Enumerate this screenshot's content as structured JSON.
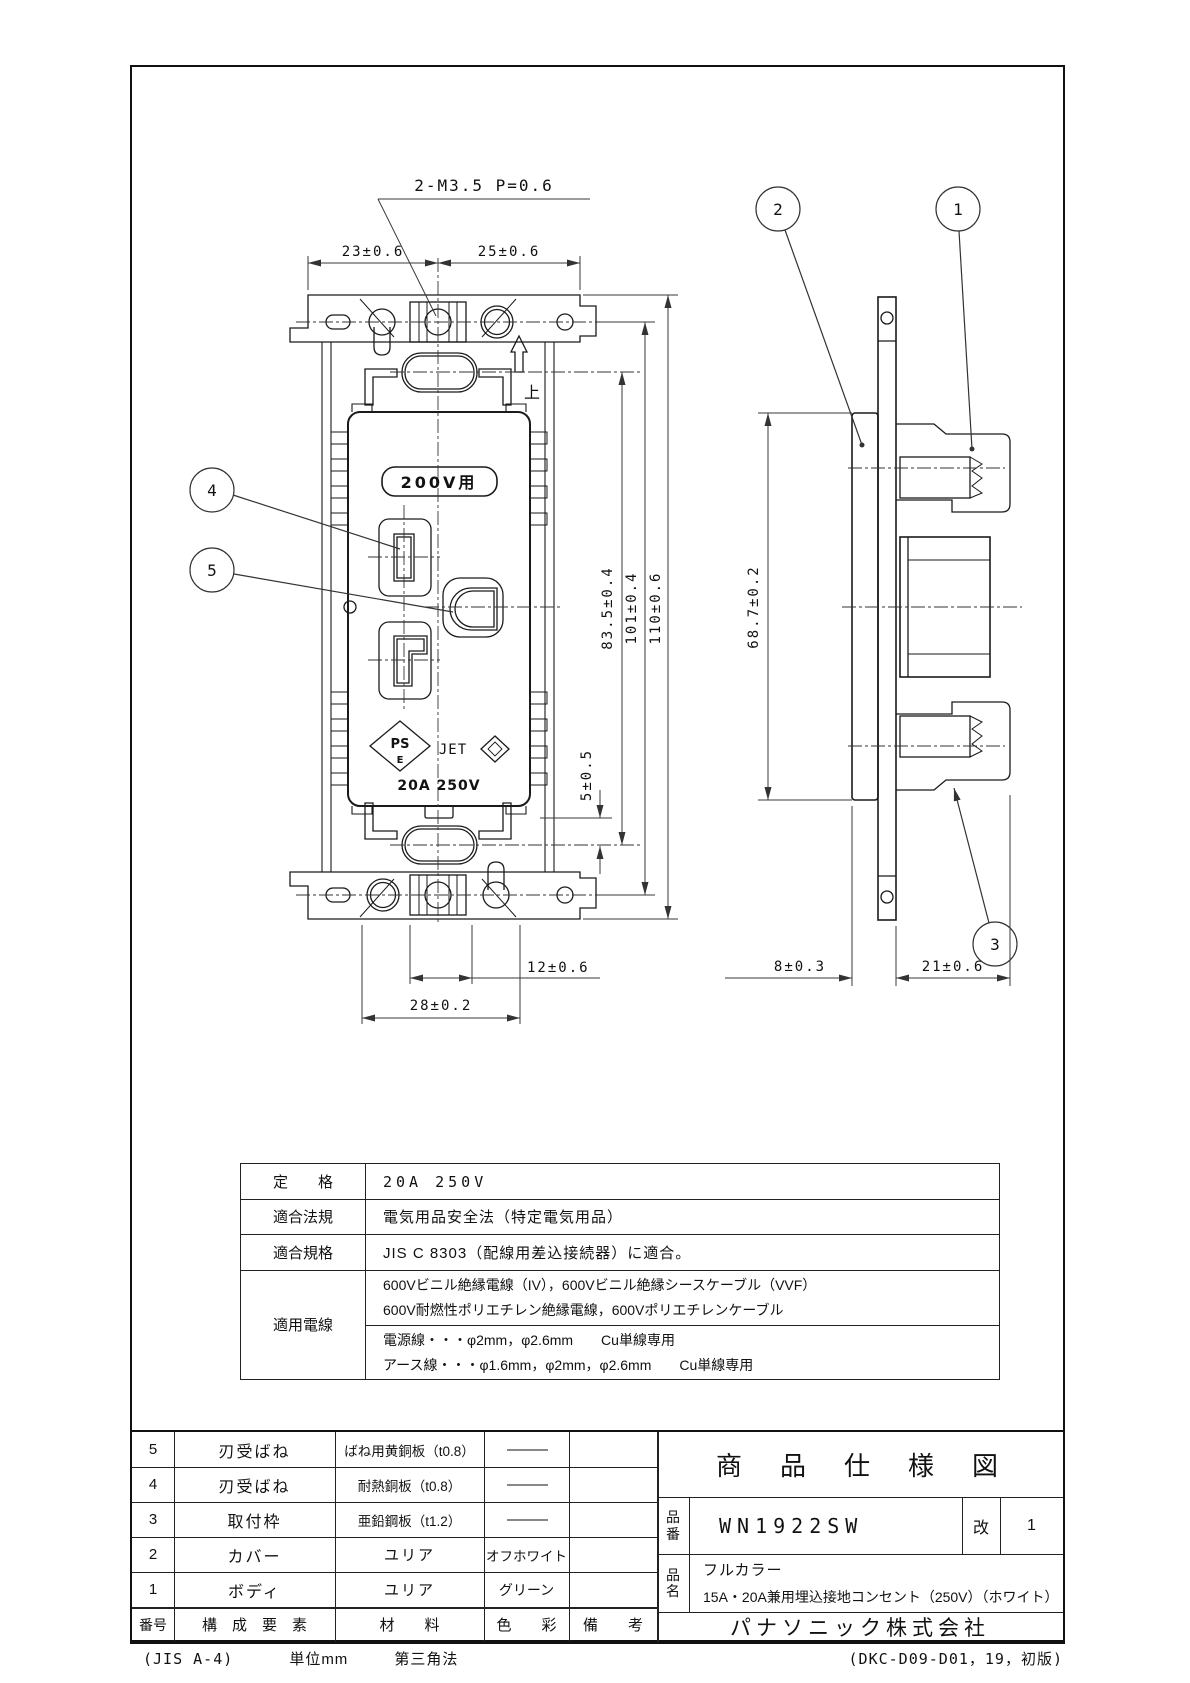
{
  "drawing": {
    "front": {
      "screw_note": "2-M3.5 P=0.6",
      "voltage_label": "200V用",
      "pse_line1": "PS",
      "pse_line2": "E",
      "cert_jet": "JET",
      "rating_mark": "20A 250V",
      "orientation_mark": "上",
      "dim_23": "23±0.6",
      "dim_25": "25±0.6",
      "dim_83_5": "83.5±0.4",
      "dim_101": "101±0.4",
      "dim_110": "110±0.6",
      "dim_5": "5±0.5",
      "dim_12": "12±0.6",
      "dim_28": "28±0.2"
    },
    "side": {
      "dim_68_7": "68.7±0.2",
      "dim_8": "8±0.3",
      "dim_21": "21±0.6"
    },
    "balloons": {
      "b1": "1",
      "b2": "2",
      "b3": "3",
      "b4": "4",
      "b5": "5"
    }
  },
  "spec_table": {
    "rating_label": "定　　格",
    "rating_value": "20A 250V",
    "law_label": "適合法規",
    "law_value": "電気用品安全法（特定電気用品）",
    "standard_label": "適合規格",
    "standard_value": "JIS C 8303（配線用差込接続器）に適合。",
    "wire_label": "適用電線",
    "wire_value_1a": "600Vビニル絶縁電線（IV），600Vビニル絶縁シースケーブル（VVF）",
    "wire_value_1b": "600V耐燃性ポリエチレン絶縁電線，600Vポリエチレンケーブル",
    "wire_value_2a": "電源線・・・φ2mm，φ2.6mm　　Cu単線専用",
    "wire_value_2b": "アース線・・・φ1.6mm，φ2mm，φ2.6mm　　Cu単線専用"
  },
  "parts_table": {
    "header": {
      "no": "番号",
      "component": "構　成　要　素",
      "material": "材　　料",
      "color": "色　　彩",
      "note": "備　　考"
    },
    "rows": [
      {
        "no": "5",
        "component": "刃受ばね",
        "material": "ばね用黄銅板（t0.8）",
        "color": "———",
        "note": ""
      },
      {
        "no": "4",
        "component": "刃受ばね",
        "material": "耐熱銅板（t0.8）",
        "color": "———",
        "note": ""
      },
      {
        "no": "3",
        "component": "取付枠",
        "material": "亜鉛鋼板（t1.2）",
        "color": "———",
        "note": ""
      },
      {
        "no": "2",
        "component": "カバー",
        "material": "ユリア",
        "color": "オフホワイト",
        "note": ""
      },
      {
        "no": "1",
        "component": "ボディ",
        "material": "ユリア",
        "color": "グリーン",
        "note": ""
      }
    ]
  },
  "title_block": {
    "title": "商　品　仕　様　図",
    "part_no_label": "品番",
    "part_no": "WN1922SW",
    "rev_label": "改",
    "rev_value": "1",
    "name_label": "品名",
    "name_line1": "フルカラー",
    "name_line2": "15A・20A兼用埋込接地コンセント（250V）（ホワイト）",
    "company": "パナソニック株式会社"
  },
  "footer": {
    "paper": "(JIS A-4)",
    "unit": "単位mm",
    "projection": "第三角法",
    "doc_no": "(DKC-D09-D01，19，初版)"
  }
}
